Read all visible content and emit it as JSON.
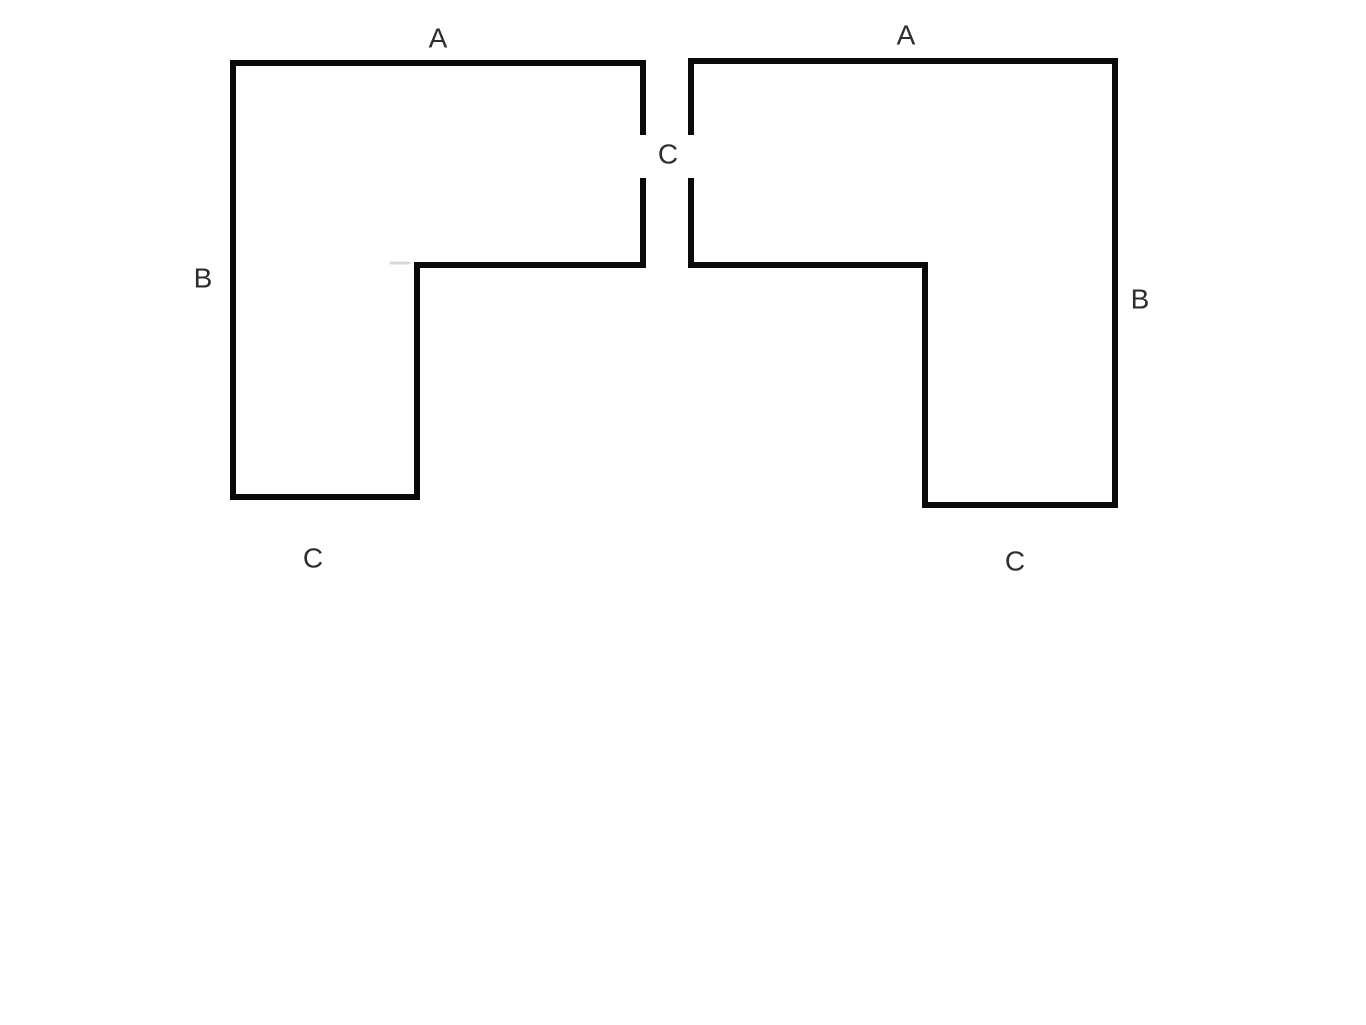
{
  "page": {
    "background": "#ffffff",
    "width": 1366,
    "height": 1025
  },
  "diagram": {
    "description": "Two mirrored L-shaped polygons, each with edges labeled A, B and C, separated by a central gap labeled C",
    "stroke": {
      "color": "#0a0a0a",
      "width": 6
    },
    "label_style": {
      "color": "#2e2e2e",
      "font_size": 28
    },
    "shapes": [
      {
        "name": "left-l-shape",
        "segments": [
          {
            "name": "left-l-shape-left-edge",
            "x1": 233,
            "y1": 497,
            "x2": 233,
            "y2": 63
          },
          {
            "name": "left-l-shape-top-edge",
            "x1": 233,
            "y1": 63,
            "x2": 643,
            "y2": 63
          },
          {
            "name": "left-l-shape-right-edge-upper",
            "x1": 643,
            "y1": 63,
            "x2": 643,
            "y2": 132
          },
          {
            "name": "left-l-shape-right-edge-lower",
            "x1": 643,
            "y1": 181,
            "x2": 643,
            "y2": 265
          },
          {
            "name": "left-l-shape-inner-horizontal",
            "x1": 643,
            "y1": 265,
            "x2": 417,
            "y2": 265
          },
          {
            "name": "left-l-shape-inner-vertical",
            "x1": 417,
            "y1": 265,
            "x2": 417,
            "y2": 497
          },
          {
            "name": "left-l-shape-bottom-edge",
            "x1": 417,
            "y1": 497,
            "x2": 233,
            "y2": 497
          }
        ]
      },
      {
        "name": "right-l-shape",
        "segments": [
          {
            "name": "right-l-shape-left-edge-upper",
            "x1": 691,
            "y1": 61,
            "x2": 691,
            "y2": 132
          },
          {
            "name": "right-l-shape-left-edge-lower",
            "x1": 691,
            "y1": 181,
            "x2": 691,
            "y2": 265
          },
          {
            "name": "right-l-shape-top-edge",
            "x1": 691,
            "y1": 61,
            "x2": 1115,
            "y2": 61
          },
          {
            "name": "right-l-shape-right-edge",
            "x1": 1115,
            "y1": 61,
            "x2": 1115,
            "y2": 505
          },
          {
            "name": "right-l-shape-inner-horizontal",
            "x1": 691,
            "y1": 265,
            "x2": 925,
            "y2": 265
          },
          {
            "name": "right-l-shape-inner-vertical",
            "x1": 925,
            "y1": 265,
            "x2": 925,
            "y2": 505
          },
          {
            "name": "right-l-shape-bottom-edge",
            "x1": 925,
            "y1": 505,
            "x2": 1115,
            "y2": 505
          }
        ]
      }
    ],
    "artifacts": [
      {
        "name": "pencil-smudge",
        "x1": 391,
        "y1": 263,
        "x2": 409,
        "y2": 263,
        "color": "#c4c4c4",
        "width": 3
      }
    ],
    "labels": [
      {
        "name": "label-a-left",
        "text": "A",
        "x": 438,
        "y": 38
      },
      {
        "name": "label-a-right",
        "text": "A",
        "x": 906,
        "y": 35
      },
      {
        "name": "label-b-left",
        "text": "B",
        "x": 203,
        "y": 278
      },
      {
        "name": "label-b-right",
        "text": "B",
        "x": 1140,
        "y": 299
      },
      {
        "name": "label-c-middle",
        "text": "C",
        "x": 668,
        "y": 154
      },
      {
        "name": "label-c-bottom-left",
        "text": "C",
        "x": 313,
        "y": 558
      },
      {
        "name": "label-c-bottom-right",
        "text": "C",
        "x": 1015,
        "y": 561
      }
    ]
  }
}
